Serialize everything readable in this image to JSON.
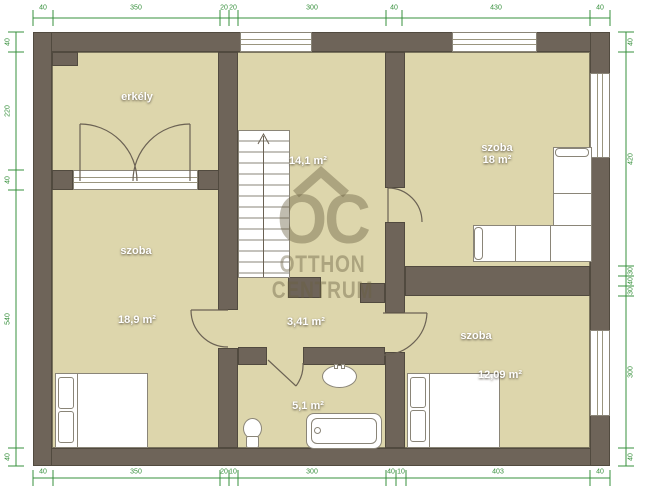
{
  "watermark": {
    "logo_text": "OC",
    "brand_line1": "OTTHON",
    "brand_line2": "CENTRUM"
  },
  "rooms": {
    "balcony": {
      "name": "erkély"
    },
    "bedroom_left": {
      "name": "szoba",
      "area": "18,9 m²"
    },
    "landing": {
      "area": "14,1 m²"
    },
    "living_room": {
      "name": "szoba",
      "area": "18 m²"
    },
    "hallway": {
      "area": "3,41 m²"
    },
    "bathroom": {
      "area": "5,1 m²"
    },
    "bedroom_right": {
      "name": "szoba",
      "area": "12,09 m²"
    }
  },
  "dimensions_cm": {
    "top": [
      {
        "t": "40",
        "c": 43
      },
      {
        "t": "350",
        "c": 136
      },
      {
        "t": "20",
        "c": 224
      },
      {
        "t": "20",
        "c": 233
      },
      {
        "t": "300",
        "c": 312
      },
      {
        "t": "40",
        "c": 394
      },
      {
        "t": "430",
        "c": 496
      },
      {
        "t": "40",
        "c": 600
      }
    ],
    "bottom": [
      {
        "t": "40",
        "c": 43
      },
      {
        "t": "350",
        "c": 136
      },
      {
        "t": "20",
        "c": 224
      },
      {
        "t": "10",
        "c": 233
      },
      {
        "t": "300",
        "c": 312
      },
      {
        "t": "40",
        "c": 391
      },
      {
        "t": "10",
        "c": 401
      },
      {
        "t": "403",
        "c": 498
      },
      {
        "t": "40",
        "c": 600
      }
    ],
    "left": [
      {
        "t": "40",
        "c": 42
      },
      {
        "t": "220",
        "c": 111
      },
      {
        "t": "40",
        "c": 180
      },
      {
        "t": "540",
        "c": 319
      },
      {
        "t": "40",
        "c": 457
      }
    ],
    "right": [
      {
        "t": "40",
        "c": 42
      },
      {
        "t": "420",
        "c": 159
      },
      {
        "t": "30",
        "c": 271
      },
      {
        "t": "40",
        "c": 281
      },
      {
        "t": "30",
        "c": 291
      },
      {
        "t": "300",
        "c": 372
      },
      {
        "t": "40",
        "c": 457
      }
    ]
  },
  "colors": {
    "wall": "#6e6459",
    "floor": "#ddd6ac",
    "dimension_green": "#37903c",
    "watermark": "rgba(104,95,64,0.42)"
  }
}
